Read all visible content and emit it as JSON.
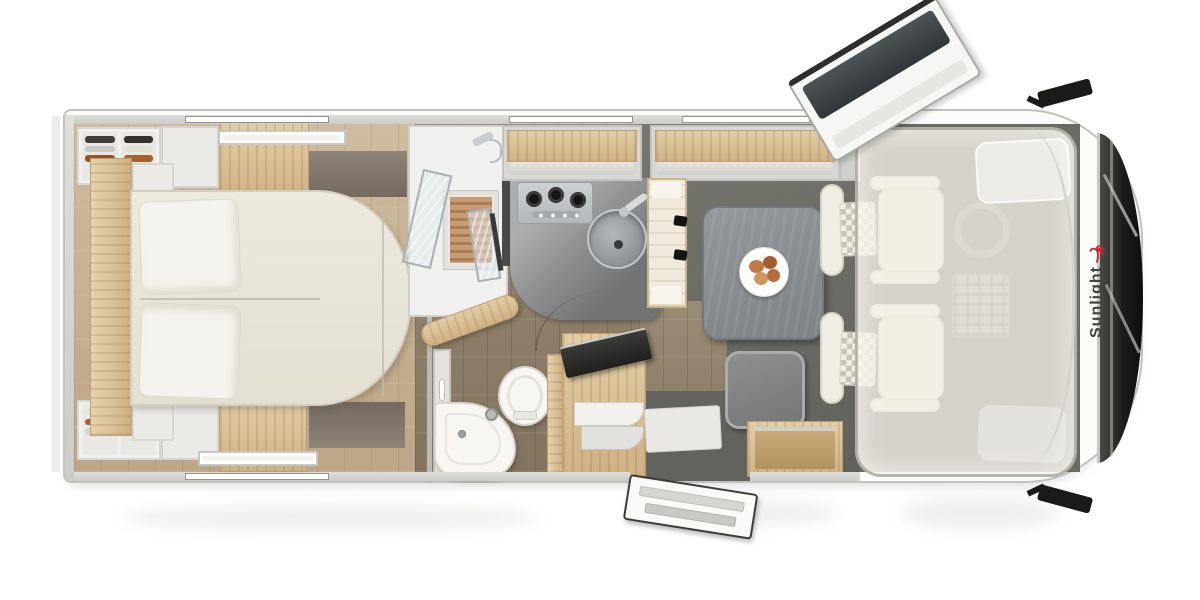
{
  "image": {
    "kind": "motorhome floor plan, photorealistic top-down render",
    "width_px": 1200,
    "height_px": 600
  },
  "brand": {
    "logo_text": "Sunlight",
    "logo_text_color": "#44413e",
    "logo_palm_color": "#cf2630"
  },
  "palette": {
    "page_background": "#ffffff",
    "body_outline": "#c2c2bf",
    "wall_gray": "#d2d2cf",
    "bedroom_floor_wood": "#c8b396",
    "hallway_floor_wood": "#93836c",
    "dinette_platform_gray": "#6f6f6a",
    "oak_cabinet": "#d9c096",
    "bed_cream": "#e9e6da",
    "pillow_white": "#f5f3ed",
    "kitchen_counter_gray": "#a0a2a4",
    "kitchen_counter_dark": "#747678",
    "table_gray": "#8f9294",
    "chair_cream": "#f0eee3",
    "windshield_dark": "#1e1e1c",
    "mirror_black": "#1a1a18"
  },
  "rooms": {
    "rear_bedroom": {
      "fixtures": [
        "double-bed",
        "pillow",
        "pillow",
        "wardrobe-with-clothes-top",
        "wardrobe-with-clothes-bottom",
        "white-locker-top",
        "white-locker-bottom",
        "oak-cabinet-top",
        "oak-cabinet-bottom",
        "dark-shelf-top",
        "dark-shelf-bottom",
        "headboard-shelf",
        "roof-vent",
        "roof-vent"
      ]
    },
    "bathroom": {
      "fixtures": [
        "shower-cabin",
        "wooden-shower-grate",
        "shower-fitting",
        "glass-door",
        "glass-door",
        "toilet",
        "open-wooden-toilet-lid",
        "corner-washbasin",
        "soap-bottle",
        "vanity-cabinet",
        "wooden-shelf"
      ]
    },
    "kitchen": {
      "fixtures": [
        "three-burner-gas-hob",
        "round-sink-with-faucet",
        "l-shaped-worktop",
        "overhead-locker",
        "dark-divider-panel"
      ]
    },
    "dinette": {
      "fixtures": [
        "dining-table",
        "plate-of-croissants",
        "travel-bench-with-two-seatbelts",
        "side-seat",
        "open-storage-box",
        "overhead-locker",
        "tv-cabinet",
        "flatscreen-tv",
        "entry-steps",
        "door-mat",
        "open-entry-door-with-steps"
      ]
    },
    "cab": {
      "fixtures": [
        "driver-swivel-seat",
        "passenger-swivel-seat",
        "steering-wheel",
        "dashboard-console",
        "translucent-drop-down-bed",
        "bed-pillow",
        "windshield-with-wipers",
        "side-mirror-top",
        "side-mirror-bottom",
        "open-cab-door",
        "front-cap-logo"
      ]
    }
  },
  "openings": {
    "windows": [
      "top-wall-rear",
      "top-wall-center",
      "top-wall-dinette",
      "bottom-wall-rear"
    ],
    "roof_vents": 2,
    "doors_open": [
      "cab-door-front-top",
      "entry-door-bottom"
    ]
  }
}
